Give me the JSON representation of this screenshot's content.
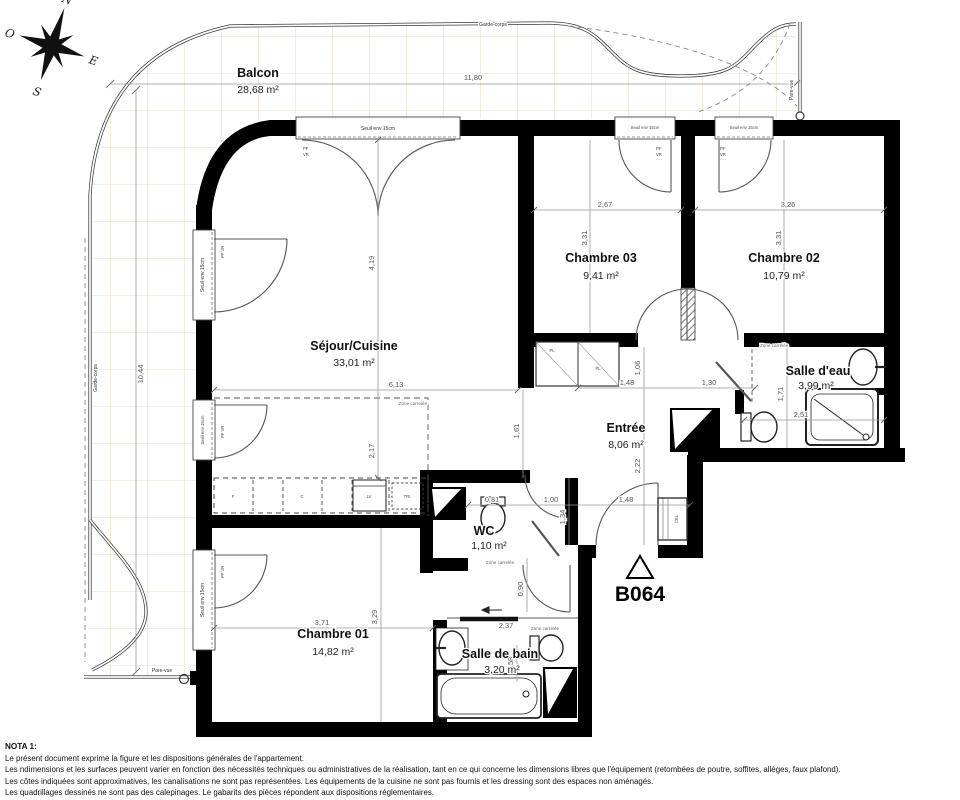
{
  "colors": {
    "wall": "#000000",
    "tile_line": "#e8dcc3",
    "dim_line": "#6b6b6b",
    "paper": "#ffffff"
  },
  "compass": {
    "n": "N",
    "e": "E",
    "s": "S",
    "o": "O"
  },
  "apartment_id": "B064",
  "balcony": {
    "name": "Balcon",
    "area": "28,68 m²"
  },
  "rooms": {
    "sejour": {
      "name": "Séjour/Cuisine",
      "area": "33,01 m²"
    },
    "chambre03": {
      "name": "Chambre 03",
      "area": "9,41 m²"
    },
    "chambre02": {
      "name": "Chambre 02",
      "area": "10,79 m²"
    },
    "salle_eau": {
      "name": "Salle d'eau",
      "area": "3,99 m²"
    },
    "entree": {
      "name": "Entrée",
      "area": "8,06 m²"
    },
    "wc": {
      "name": "WC",
      "area": "1,10 m²"
    },
    "chambre01": {
      "name": "Chambre 01",
      "area": "14,82 m²"
    },
    "salle_bain": {
      "name": "Salle de bain",
      "area": "3,20 m²"
    }
  },
  "dims": {
    "balcon_w": "11,80",
    "balcon_h": "10,44",
    "sejour_w": "6,13",
    "sejour_h": "4,19",
    "kitchen_d": "2,17",
    "opening": "1,61",
    "ch3_w": "2,67",
    "ch3_h": "3,31",
    "ch2_w": "3,26",
    "ch2_h": "3,31",
    "entree_a": "1,48",
    "entree_b": "1,30",
    "entree_c": "1,06",
    "entree_d": "2,22",
    "wc_w": "0,81",
    "hall_w": "1,00",
    "door_w": "1,48",
    "hall_l": "1,34",
    "ch1_door": "0,90",
    "sde_h": "1,71",
    "sde_w": "2,51",
    "ch1_w": "3,71",
    "ch1_h": "3,29",
    "sdb_w": "2,37",
    "sdb_n": "0,58"
  },
  "labels": {
    "seuil": "Seuil env 15cm",
    "pf": "PF",
    "vr": "VR",
    "pf_vr": "PF VR",
    "garde_corps": "Garde-corps",
    "pare_vue": "Pare-vue",
    "zone_carrelee": "Zone carrelée",
    "pl": "PL",
    "cel": "CEL",
    "f": "F",
    "c": "C",
    "lv": "LV",
    "tri": "TRI"
  },
  "nota": {
    "title": "NOTA 1:",
    "lines": [
      "Le présent document exprime la figure et les dispositions générales de l'appartement.",
      "Les ndimensions et les surfaces peuvent varier en fonction des nécessités techniques ou administratives de la réalisation, tant en ce qui concerne les dimensions libres que l'équipement (retombées de poutre, soffites, allèges, faux plafond).",
      "Les côtes indiquées sont approximatives, les canalisations ne sont pas représentées. Les équipements de la cuisine ne sont pas fournis et les dressing sont des espaces non aménagés.",
      "Les quadrillages dessinés ne sont pas des calepinages. Le gabarits des pièces répondent aux dispositions réglementaires."
    ]
  }
}
